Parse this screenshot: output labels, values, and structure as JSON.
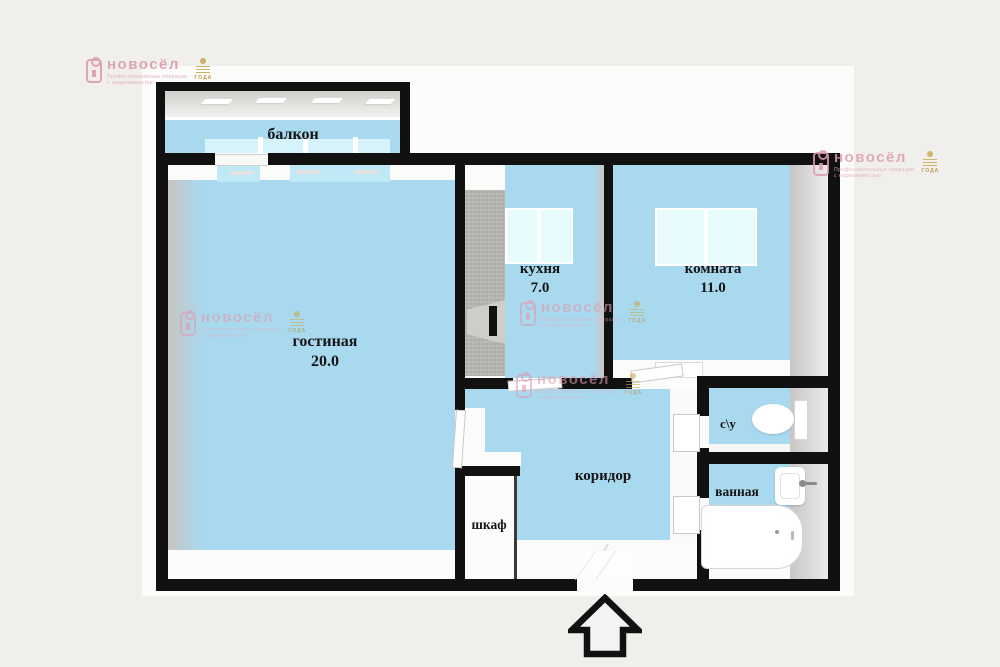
{
  "title": "apartment-floor-plan",
  "colors": {
    "background": "#f0efec",
    "floor_blue": "#a9d9ef",
    "window_blue": "#e7fbfd",
    "wall_black": "#111111",
    "brand_pink": "#dd9db1",
    "award_gold": "#b5923b"
  },
  "rooms": [
    {
      "label": "балкон",
      "area": ""
    },
    {
      "label": "гостиная",
      "area": "20.0"
    },
    {
      "label": "кухня",
      "area": "7.0"
    },
    {
      "label": "комната",
      "area": "11.0"
    },
    {
      "label": "с\\у",
      "area": ""
    },
    {
      "label": "ванная",
      "area": ""
    },
    {
      "label": "коридор",
      "area": ""
    },
    {
      "label": "шкаф",
      "area": ""
    }
  ],
  "watermark": {
    "brand": "новосёл",
    "tagline_line1": "Профессиональные операции",
    "tagline_line2": "с недвижимостью",
    "award": "ГОДА"
  }
}
